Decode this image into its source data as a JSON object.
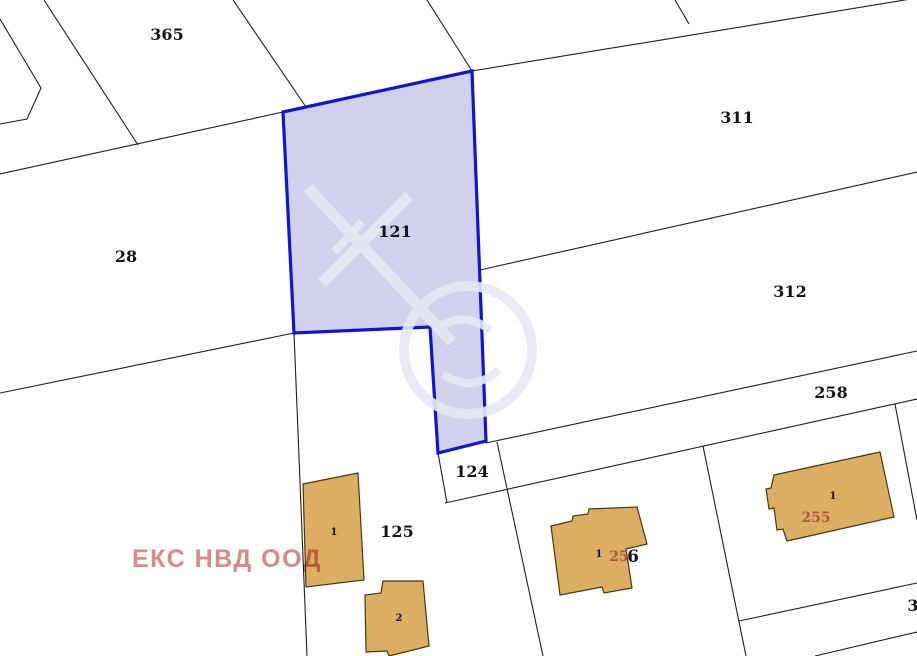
{
  "map": {
    "selected_parcel": "121",
    "labels": {
      "parcel_365": "365",
      "parcel_28": "28",
      "parcel_121": "121",
      "parcel_311": "311",
      "parcel_312": "312",
      "parcel_258": "258",
      "parcel_124": "124",
      "parcel_125": "125",
      "parcel_edge_partial": "3",
      "building_125_1": "1",
      "building_125_2": "2",
      "building_256_1": "1",
      "building_256_red": "25",
      "building_256_black": "6",
      "building_255_1": "1",
      "building_255_red": "255"
    },
    "watermark_text": "ЕКС НВД ООД",
    "colors": {
      "selected_parcel_fill": "#d0d2ec",
      "selected_parcel_border": "#1313d0",
      "building_fill": "#dcae63",
      "building_stroke": "#46390f",
      "boundary_line": "#1f1f1f",
      "company_watermark_red": "#d98989",
      "building_number_red": "#a8563c"
    }
  }
}
